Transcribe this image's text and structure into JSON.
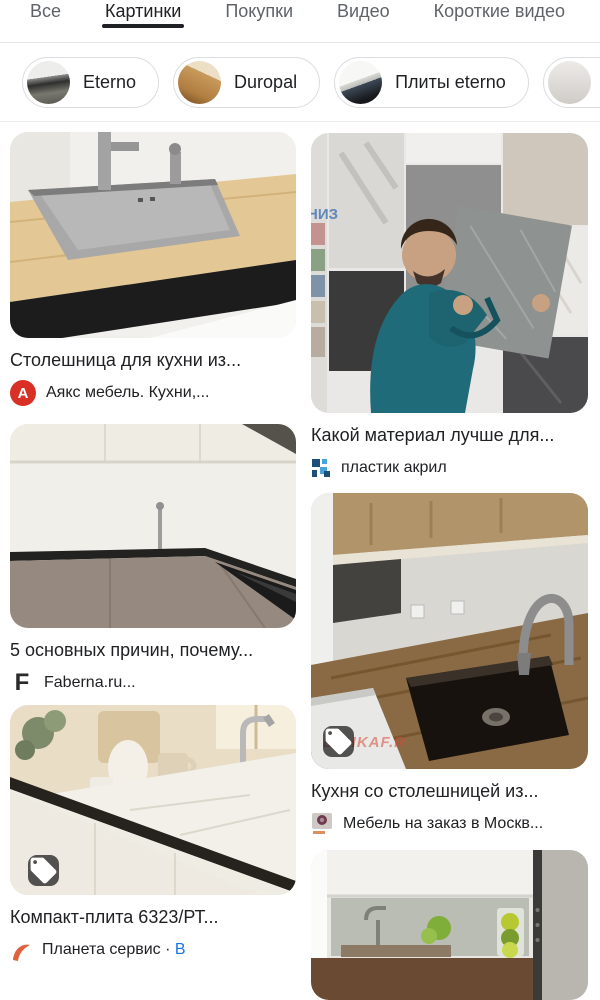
{
  "tabs": {
    "items": [
      {
        "label": "Все",
        "selected": false
      },
      {
        "label": "Картинки",
        "selected": true
      },
      {
        "label": "Покупки",
        "selected": false
      },
      {
        "label": "Видео",
        "selected": false
      },
      {
        "label": "Короткие видео",
        "selected": false
      }
    ],
    "underline_color": "#202124"
  },
  "chips": {
    "items": [
      {
        "label": "Eterno",
        "thumb": "dark-kitchen-photo"
      },
      {
        "label": "Duropal",
        "thumb": "wood-countertop-photo"
      },
      {
        "label": "Плиты eterno",
        "thumb": "white-blue-kitchen-photo"
      },
      {
        "label": "",
        "thumb": "light-marble-photo"
      }
    ],
    "border_color": "#dadce0"
  },
  "results": {
    "left": [
      {
        "title": "Столешница для кухни из...",
        "source": "Аякс мебель. Кухни,...",
        "favicon": "letter-avatar",
        "favicon_letter": "A",
        "favicon_color": "#d93025",
        "image_desc": "steel-sink-wood-countertop"
      },
      {
        "title": "5 основных причин, почему...",
        "source": "Faberna.ru...",
        "favicon": "letter-logo",
        "favicon_letter": "F",
        "image_desc": "corner-kitchen-taupe-cabinets"
      },
      {
        "title": "Компакт-плита 6323/РТ...",
        "source_prefix": "Планета сервис ·",
        "source_link": "В",
        "favicon": "orange-logo",
        "has_product_tag": true,
        "image_desc": "beige-kitchen-marble-counter"
      }
    ],
    "right": [
      {
        "title": "Какой материал лучше для...",
        "source": "пластик акрил",
        "favicon": "blue-pixel-logo",
        "photo_text": "НИЗ",
        "image_desc": "man-holding-tile-sample"
      },
      {
        "title": "Кухня со столешницей из...",
        "source": "Мебель на заказ в Москв...",
        "favicon": "photo-favicon",
        "has_product_tag": true,
        "watermark": "ESHKAF.R",
        "image_desc": "dark-sink-wood-countertop"
      },
      {
        "title": "",
        "source": "",
        "image_desc": "white-kitchen-limes-partial"
      }
    ]
  },
  "colors": {
    "tag_badge": "rgba(22,22,22,0.72)",
    "stock_link_blue": "#1a73e8",
    "ayaks_red": "#d93025",
    "title_text": "#202124",
    "tab_inactive": "#5f6368"
  }
}
